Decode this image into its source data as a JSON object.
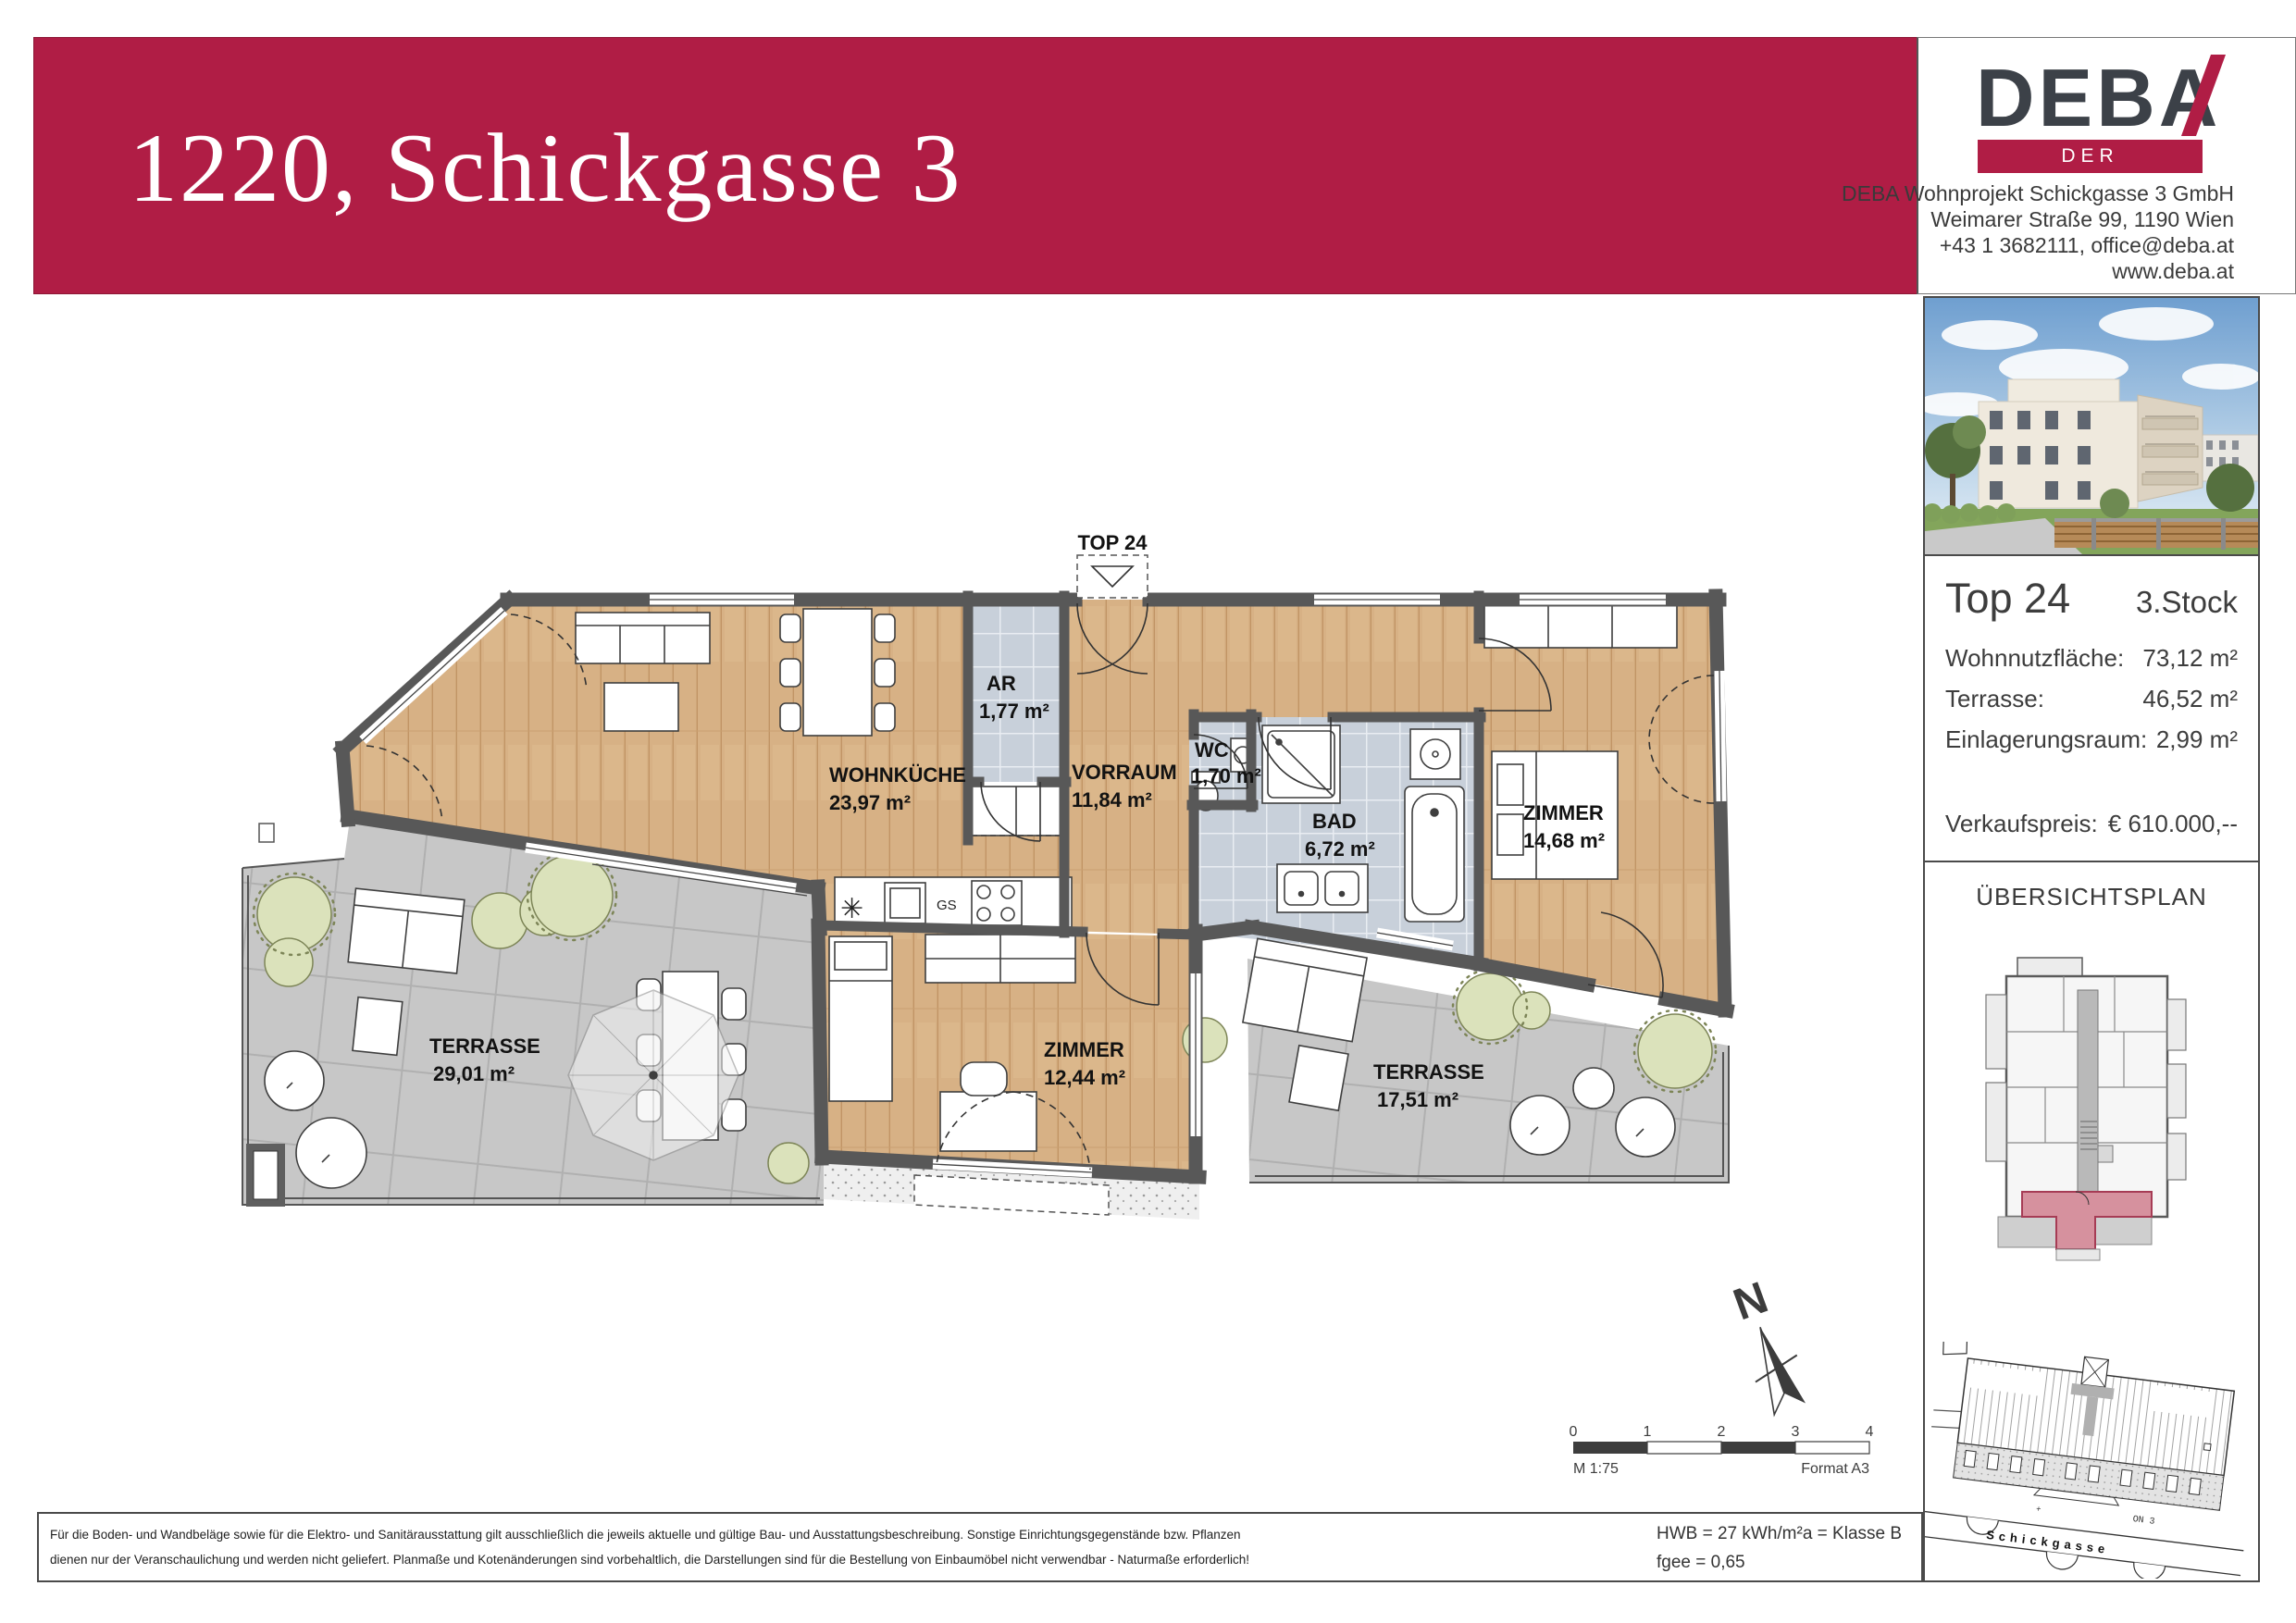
{
  "header": {
    "title": "1220, Schickgasse 3",
    "banner_color": "#b01d45",
    "logo": {
      "brand": "DEBA",
      "tagline": "DER BAUTRÄGER"
    },
    "company": {
      "line1": "DEBA Wohnprojekt Schickgasse 3 GmbH",
      "line2": "Weimarer Straße 99, 1190 Wien",
      "line3": "+43 1 3682111, office@deba.at",
      "line4": "www.deba.at"
    }
  },
  "unit_panel": {
    "unit": "Top 24",
    "floor": "3.Stock",
    "rows": [
      {
        "label": "Wohnnutzfläche:",
        "value": "73,12 m²"
      },
      {
        "label": "Terrasse:",
        "value": "46,52 m²"
      },
      {
        "label": "Einlagerungsraum:",
        "value": "2,99 m²"
      }
    ],
    "price_label": "Verkaufspreis:",
    "price_value": "€ 610.000,--"
  },
  "overview": {
    "title": "ÜBERSICHTSPLAN",
    "street_label": "Schickgasse",
    "house_label": "ON 3",
    "highlight_color": "#d6919e"
  },
  "floorplan": {
    "entrance_label": "TOP 24",
    "kitchen_gs": "GS",
    "north_label": "N",
    "rooms": [
      {
        "name": "WOHNKÜCHE",
        "area": "23,97 m²"
      },
      {
        "name": "AR",
        "area": "1,77 m²"
      },
      {
        "name": "VORRAUM",
        "area": "11,84 m²"
      },
      {
        "name": "WC",
        "area": "1,70 m²"
      },
      {
        "name": "BAD",
        "area": "6,72 m²"
      },
      {
        "name": "ZIMMER",
        "area": "14,68 m²"
      },
      {
        "name": "ZIMMER",
        "area": "12,44 m²"
      },
      {
        "name": "TERRASSE",
        "area": "29,01 m²"
      },
      {
        "name": "TERRASSE",
        "area": "17,51 m²"
      }
    ],
    "colors": {
      "wood": "#d7b185",
      "tile": "#c8d0da",
      "terrace": "#c7c7c7",
      "wall": "#585858"
    }
  },
  "scalebar": {
    "ticks": [
      "0",
      "1",
      "2",
      "3",
      "4"
    ],
    "scale_label": "M 1:75",
    "format_label": "Format A3"
  },
  "footer": {
    "disclaimer_line1": "Für die Boden- und Wandbeläge sowie für die Elektro- und Sanitärausstattung gilt ausschließlich die jeweils aktuelle und gültige Bau- und Ausstattungsbeschreibung. Sonstige Einrichtungsgegenstände bzw. Pflanzen",
    "disclaimer_line2": "dienen nur der Veranschaulichung und werden nicht geliefert. Planmaße und Kotenänderungen sind vorbehaltlich, die Darstellungen sind für die Bestellung von Einbaumöbel nicht verwendbar - Naturmaße erforderlich!",
    "energy_line1": "HWB = 27 kWh/m²a = Klasse B",
    "energy_line2": "fgee = 0,65"
  }
}
